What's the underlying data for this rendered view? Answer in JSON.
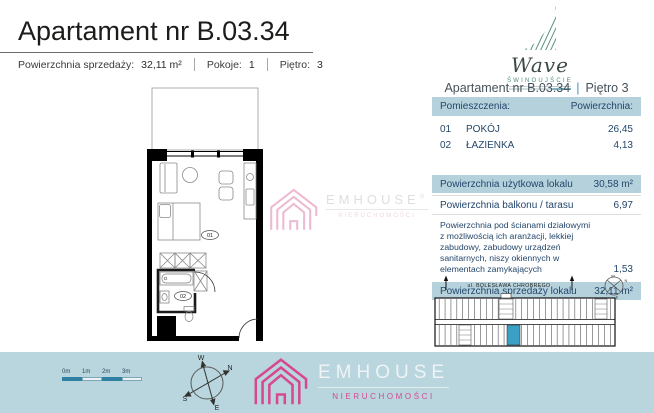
{
  "header": {
    "title": "Apartament nr B.03.34",
    "meta": [
      {
        "label": "Powierzchnia sprzedaży:",
        "value": "32,11 m²"
      },
      {
        "label": "Pokoje:",
        "value": "1"
      },
      {
        "label": "Piętro:",
        "value": "3"
      }
    ]
  },
  "wave_logo": {
    "name": "Wave",
    "city": "ŚWINOUJŚCIE"
  },
  "unit_panel": {
    "title_left": "Apartament nr B.03.34",
    "separator": "|",
    "title_right": "Piętro 3",
    "table": {
      "header": {
        "rooms": "Pomieszczenia:",
        "area": "Powierzchnia:"
      },
      "rooms": [
        {
          "no": "01",
          "name": "POKÓJ",
          "area": "26,45"
        },
        {
          "no": "02",
          "name": "ŁAZIENKA",
          "area": "4,13"
        }
      ],
      "summary": [
        {
          "label": "Powierzchnia użytkowa lokalu",
          "value": "30,58 m²"
        },
        {
          "label": "Powierzchnia balkonu / tarasu",
          "value": "6,97"
        },
        {
          "label": "Powierzchnia pod ścianami działowymi z możliwością ich aranżacji, lekkiej zabudowy, zabudowy urządzeń sanitarnych, niszy okiennych w elementach zamykających",
          "value": "1,53"
        },
        {
          "label": "Powierzchnia sprzedaży lokalu",
          "value": "32,11 m²"
        }
      ]
    }
  },
  "floorplan": {
    "room1_label": "01",
    "room2_label": "02"
  },
  "siteplan": {
    "street": "ul. BOLESŁAWA CHROBREGO"
  },
  "footer": {
    "scalebar_labels": [
      "0m",
      "1m",
      "2m",
      "3m"
    ],
    "compass": {
      "n": "N",
      "s": "S",
      "e": "E",
      "w": "W"
    },
    "logo": {
      "name": "EMHOUSE",
      "sub": "NIERUCHOMOŚCI"
    }
  },
  "watermark": {
    "name": "EMHOUSE",
    "reg": "®",
    "sub": "NIERUCHOMOŚCI"
  },
  "colors": {
    "table_blue": "#b5d2dc",
    "navy_text": "#24466b",
    "strip_blue": "#b9d5de",
    "brand_pink": "#d6488f",
    "wave_teal": "#4f8b7e",
    "unit_highlight": "#3aa0c4",
    "scalebar_dark": "#2f80a2"
  }
}
